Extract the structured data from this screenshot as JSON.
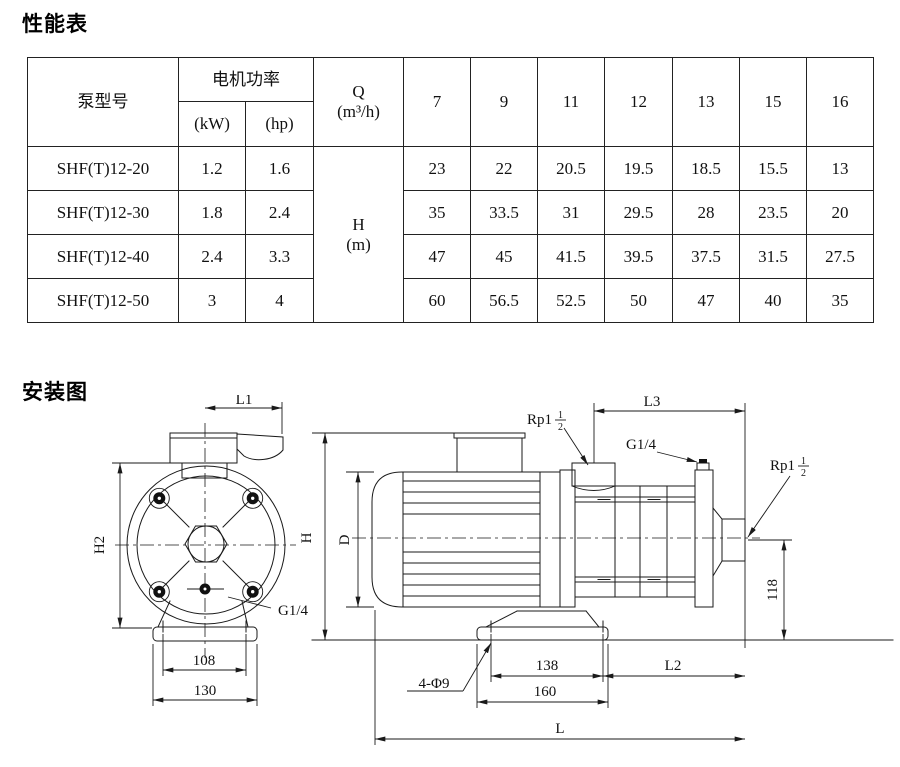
{
  "performance": {
    "title": "性能表",
    "header": {
      "pump_model": "泵型号",
      "motor_power": "电机功率",
      "kw_unit": "(kW)",
      "hp_unit": "(hp)",
      "q_label": "Q",
      "q_unit": "(m³/h)",
      "flow_values": [
        "7",
        "9",
        "11",
        "12",
        "13",
        "15",
        "16"
      ],
      "head_label": "H",
      "head_unit": "(m)"
    },
    "rows": [
      {
        "model": "SHF(T)12-20",
        "kw": "1.2",
        "hp": "1.6",
        "heads": [
          "23",
          "22",
          "20.5",
          "19.5",
          "18.5",
          "15.5",
          "13"
        ]
      },
      {
        "model": "SHF(T)12-30",
        "kw": "1.8",
        "hp": "2.4",
        "heads": [
          "35",
          "33.5",
          "31",
          "29.5",
          "28",
          "23.5",
          "20"
        ]
      },
      {
        "model": "SHF(T)12-40",
        "kw": "2.4",
        "hp": "3.3",
        "heads": [
          "47",
          "45",
          "41.5",
          "39.5",
          "37.5",
          "31.5",
          "27.5"
        ]
      },
      {
        "model": "SHF(T)12-50",
        "kw": "3",
        "hp": "4",
        "heads": [
          "60",
          "56.5",
          "52.5",
          "50",
          "47",
          "40",
          "35"
        ]
      }
    ]
  },
  "installation": {
    "title": "安装图",
    "front": {
      "l1": "L1",
      "h2": "H2",
      "g14": "G1/4",
      "bolt_span": "108",
      "base_width": "130"
    },
    "side": {
      "rp_prefix": "Rp1",
      "rp_num": "1",
      "rp_den": "2",
      "l3": "L3",
      "g14": "G1/4",
      "h": "H",
      "d": "D",
      "port_height": "118",
      "bolt_holes": "4-Φ9",
      "bolt_span": "138",
      "l2": "L2",
      "base_len": "160",
      "l": "L"
    }
  }
}
